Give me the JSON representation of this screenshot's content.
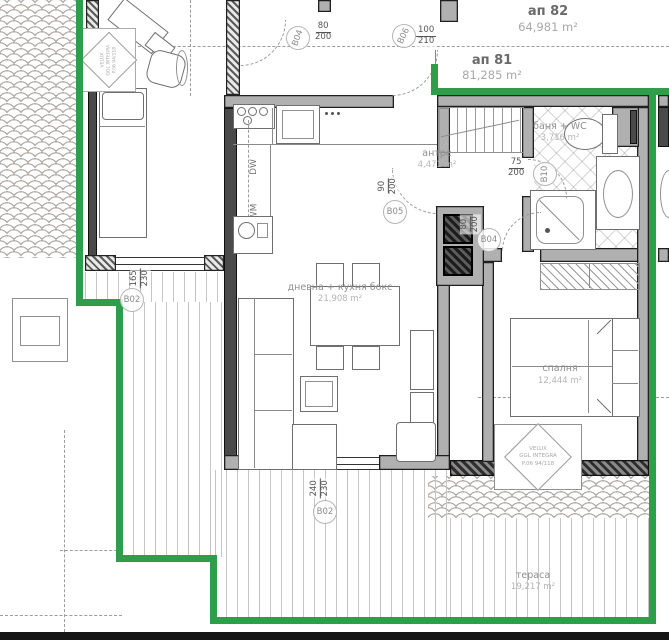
{
  "apartments": {
    "apt82": {
      "label": "ап 82",
      "area": "64,981 m²"
    },
    "apt81": {
      "label": "ап 81",
      "area": "81,285 m²"
    }
  },
  "rooms": {
    "hallway": {
      "name": "антре",
      "area": "4,471 m²"
    },
    "bathroom": {
      "name": "баня + WC",
      "area": "3,716 m²"
    },
    "living": {
      "name": "дневна + кухня бокс",
      "area": "21,908 m²"
    },
    "bedroom": {
      "name": "спалня",
      "area": "12,444 m²"
    },
    "terrace": {
      "name": "тераса",
      "area": "19,217 m²"
    }
  },
  "openings": {
    "b04_top": {
      "id": "B04",
      "w": "80",
      "h": "200"
    },
    "b06_entry": {
      "id": "B06",
      "w": "100",
      "h": "210"
    },
    "b05_living": {
      "id": "B05",
      "w": "90",
      "h": "200"
    },
    "b04_bedroom": {
      "id": "B04",
      "w": "80",
      "h": "200"
    },
    "b10_bath": {
      "id": "B10",
      "w": "75",
      "h": "200"
    },
    "b02_left": {
      "id": "B02",
      "w": "165",
      "h": "230"
    },
    "b02_terrace": {
      "id": "B02",
      "w": "240",
      "h": "230"
    }
  },
  "kitchen": {
    "dishwasher": "DW",
    "washing_machine": "WM"
  },
  "roof_window": {
    "brand": "VELUX",
    "model": "GGL INTEGRA",
    "size": "P.06 94/118"
  },
  "colors": {
    "boundary_green": "#2f9e4a"
  }
}
